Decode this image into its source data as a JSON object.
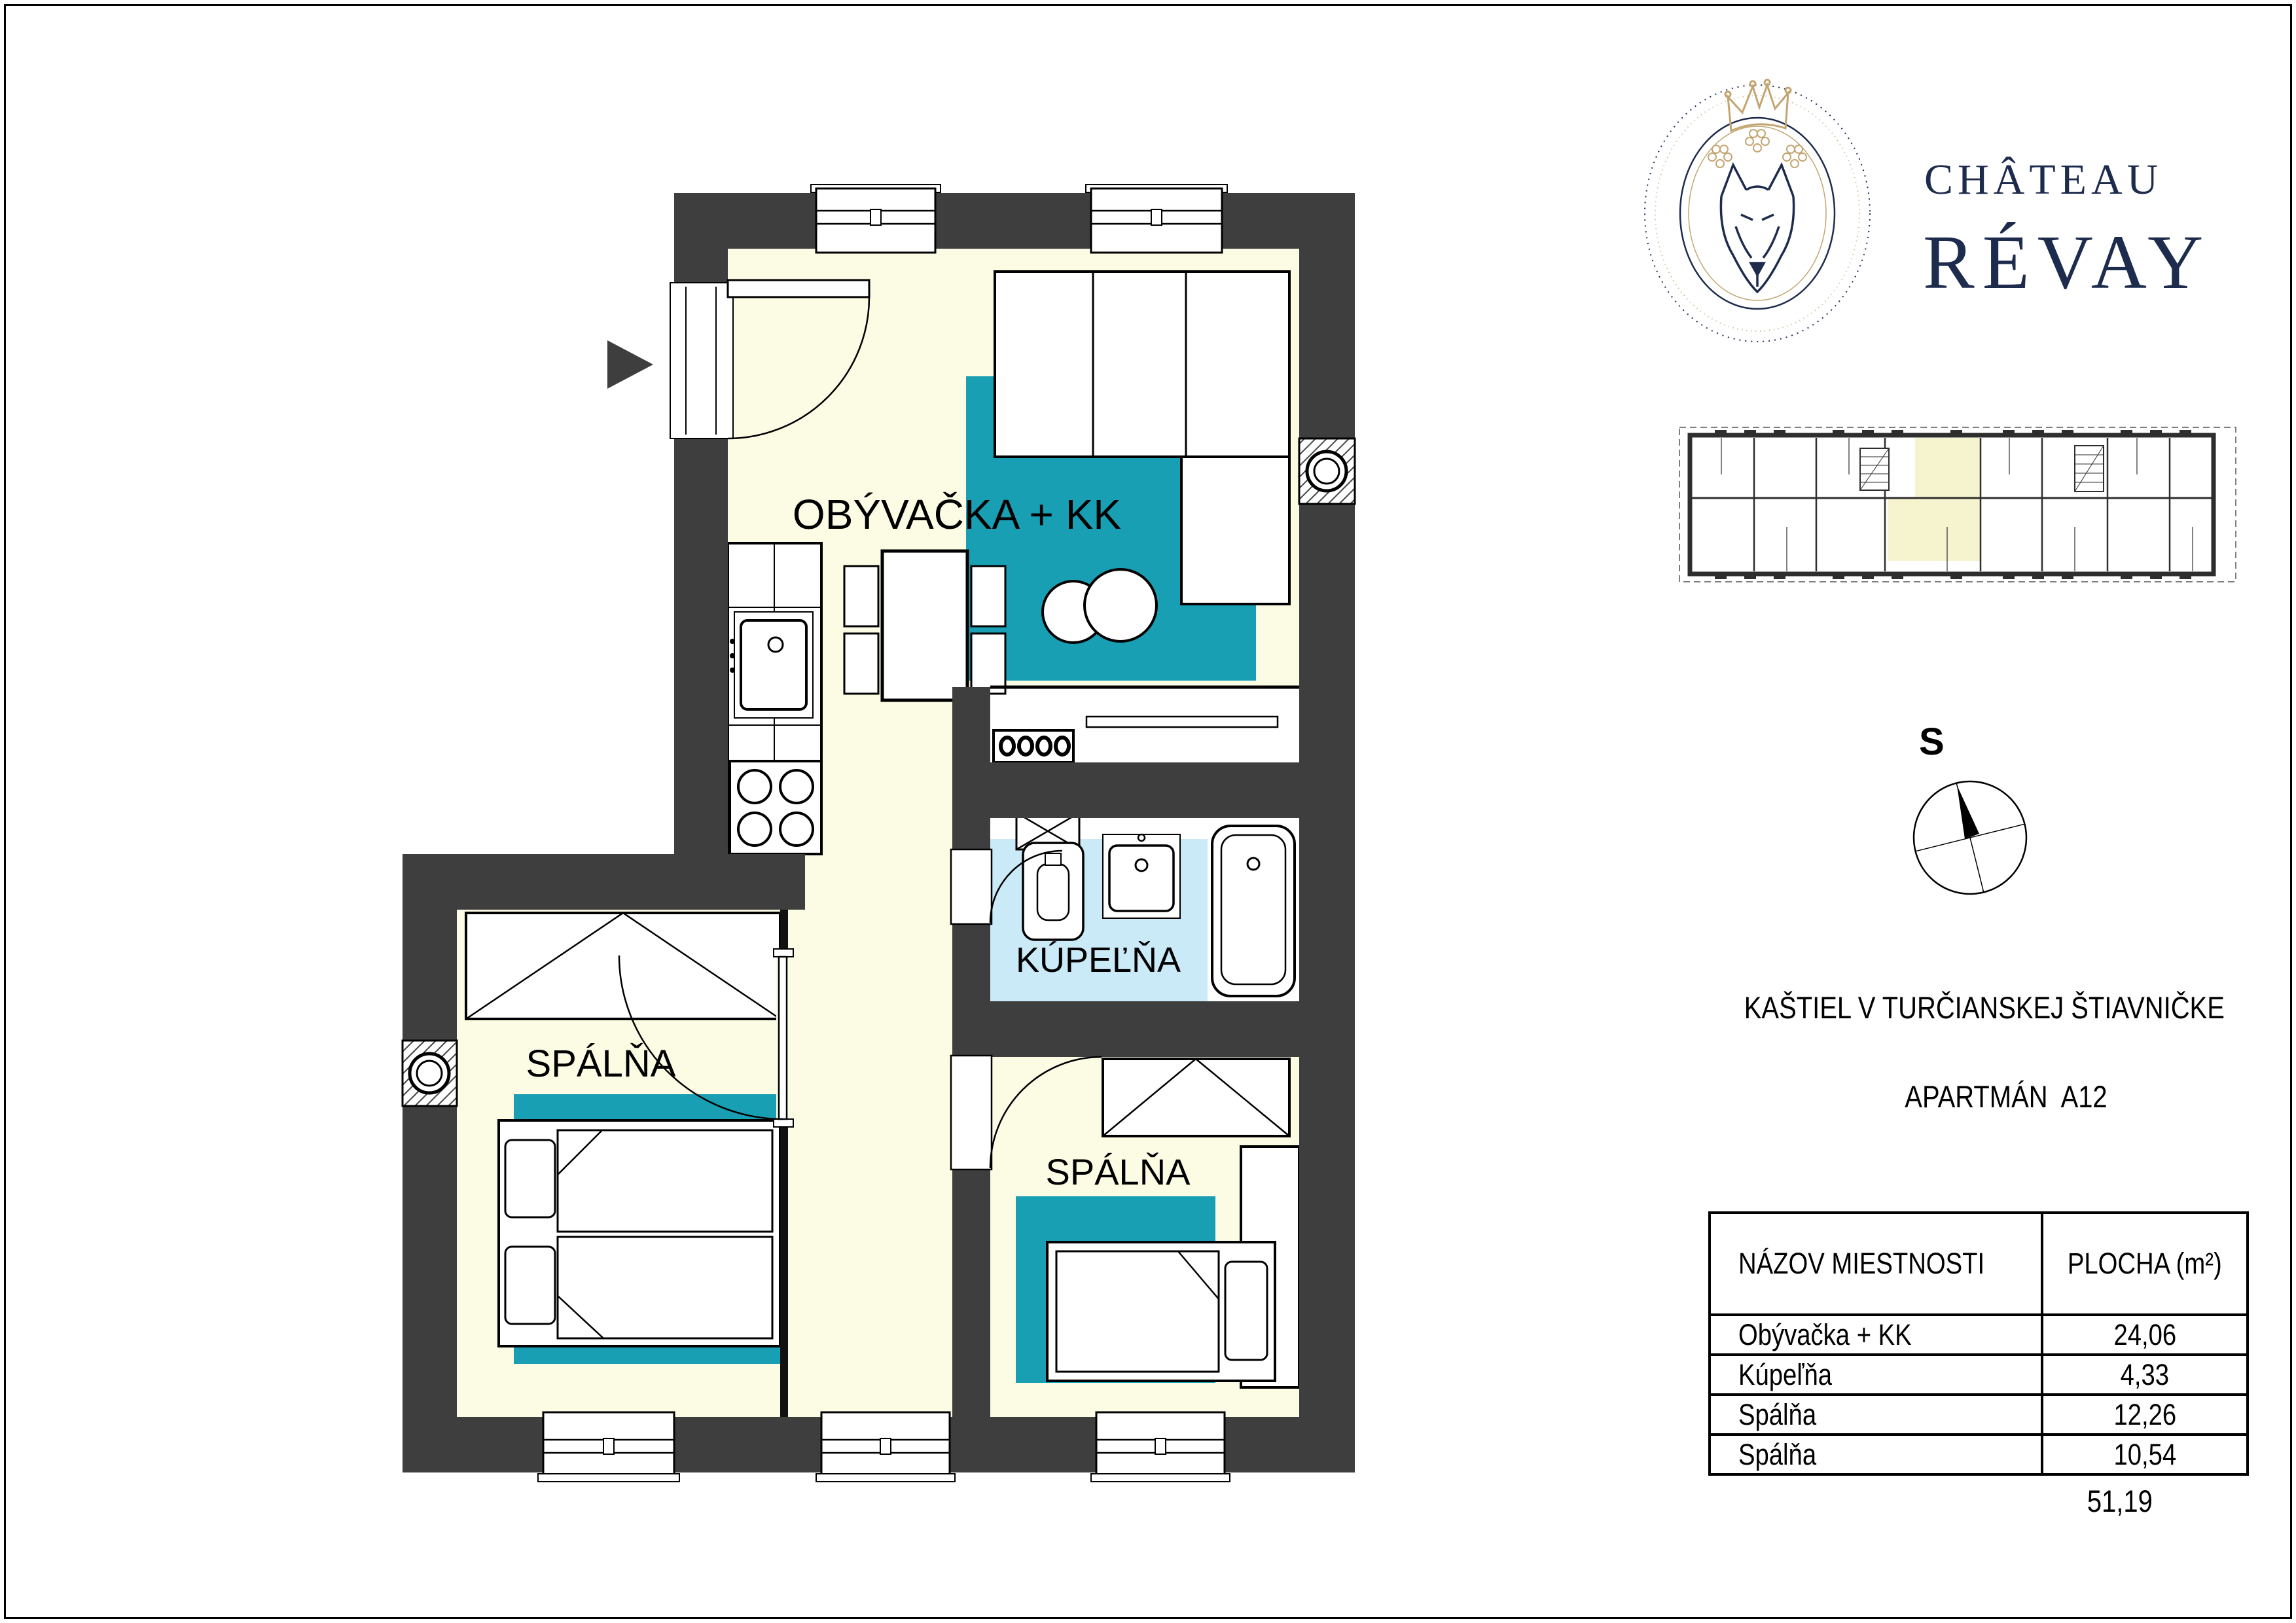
{
  "floorplan": {
    "labels": {
      "living": "OBÝVAČKA + KK",
      "bathroom": "KÚPEĽŇA",
      "bedroom1": "SPÁLŇA",
      "bedroom2": "SPÁLŇA"
    },
    "colors": {
      "wall": "#3E3E3E",
      "floor": "#FCFBE4",
      "bath_floor": "#CBEAF8",
      "rug": "#189FB4"
    }
  },
  "brand": {
    "line1": "CHÂTEAU",
    "line2": "RÉVAY",
    "navy": "#1D2B4D",
    "gold": "#C3A571"
  },
  "compass": {
    "label": "S"
  },
  "project": {
    "title": "KAŠTIEL V TURČIANSKEJ ŠTIAVNIČKE",
    "subtitle": "APARTMÁN  A12"
  },
  "area_table": {
    "headers": [
      "NÁZOV MIESTNOSTI",
      "PLOCHA (m²)"
    ],
    "rows": [
      [
        "Obývačka + KK",
        "24,06"
      ],
      [
        "Kúpeľňa",
        "4,33"
      ],
      [
        "Spálňa",
        "12,26"
      ],
      [
        "Spálňa",
        "10,54"
      ]
    ],
    "total": "51,19"
  },
  "overview": {
    "highlight": "#F6F4CF"
  }
}
